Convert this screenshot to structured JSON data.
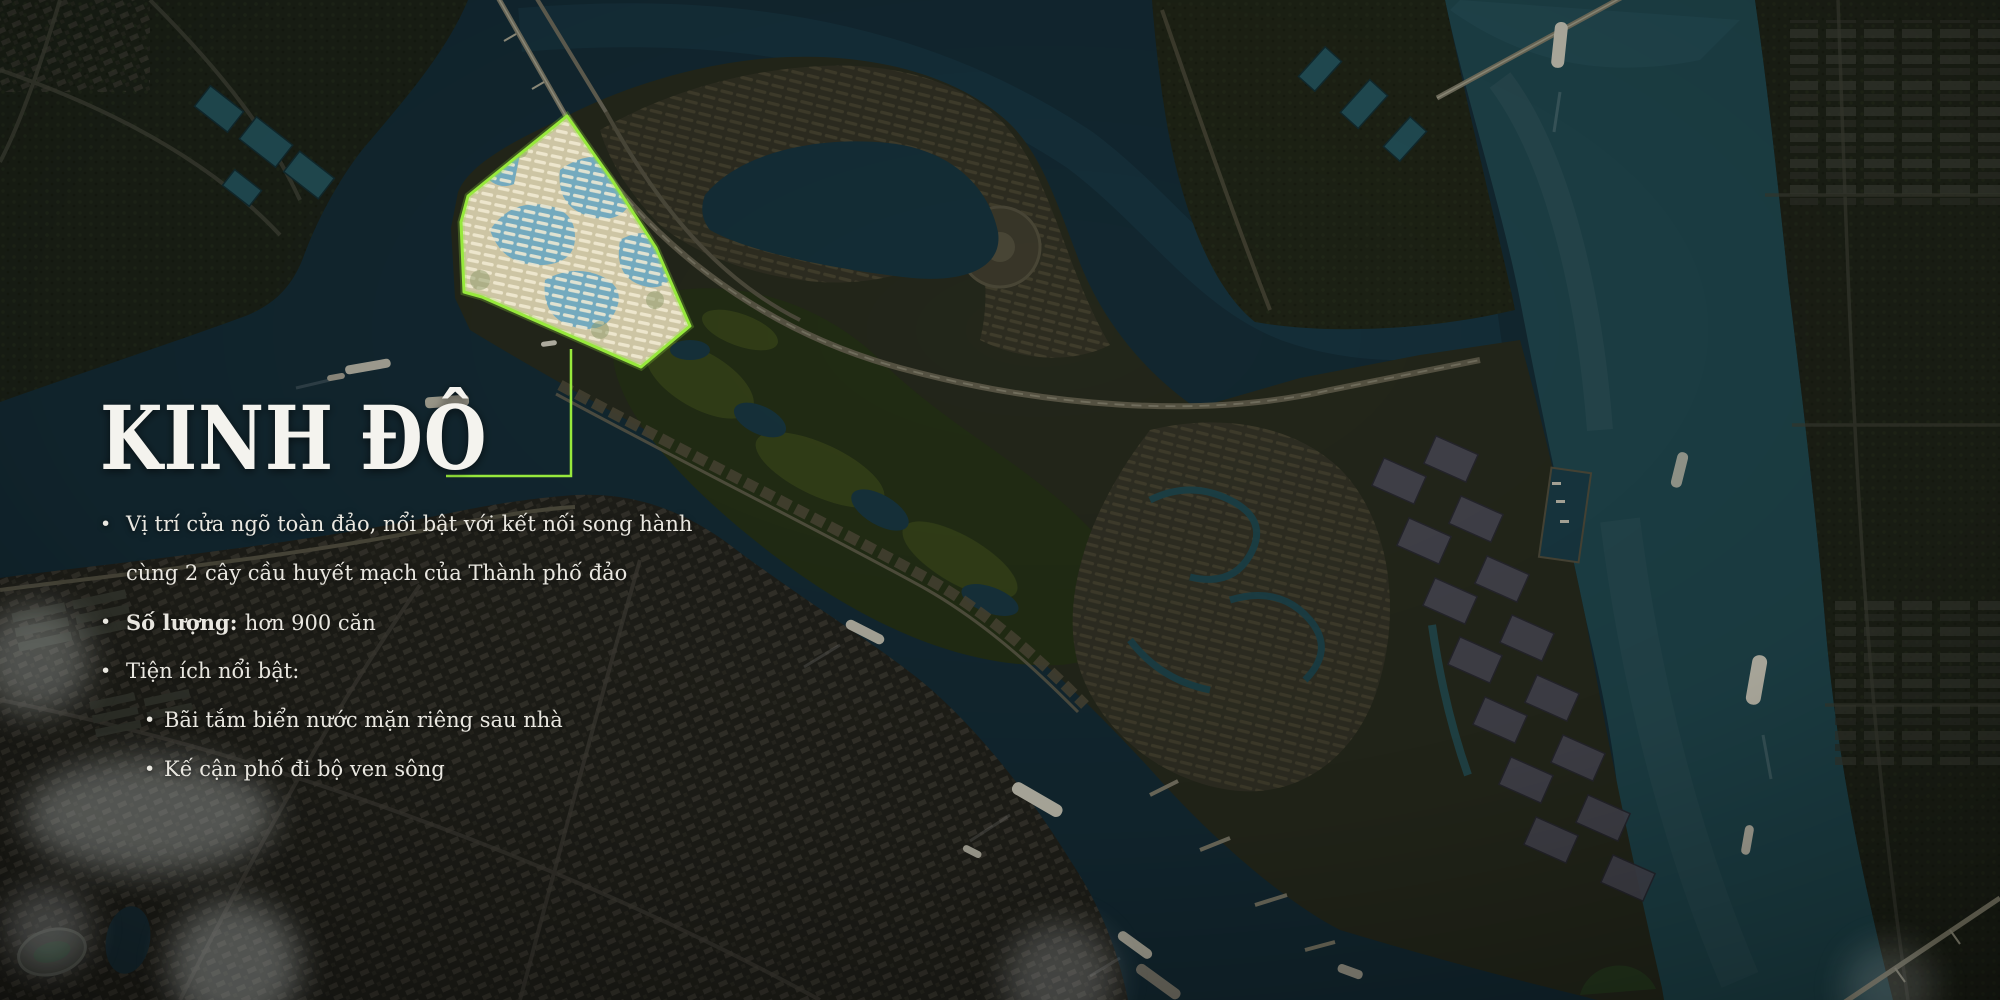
{
  "slide": {
    "title": "KINH ĐÔ",
    "bullet_glyph": "•",
    "bullets": [
      {
        "level": 1,
        "lines": [
          "Vị trí cửa ngõ toàn đảo, nổi bật với kết nối song hành",
          "cùng 2 cây cầu huyết mạch của Thành phố đảo"
        ]
      },
      {
        "level": 1,
        "label": "Số lượng:",
        "text": "hơn 900 căn"
      },
      {
        "level": 1,
        "text": "Tiện ích nổi bật:"
      },
      {
        "level": 2,
        "text": "Bãi tắm biển nước mặn riêng sau nhà"
      },
      {
        "level": 2,
        "text": "Kế cận phố đi bộ ven sông"
      }
    ],
    "map": {
      "type": "aerial-masterplan",
      "highlight_outline_color": "#97e93c",
      "water_color": "#17313c",
      "river_color": "#245058",
      "highlight_fill": "#cdc5a4"
    }
  }
}
